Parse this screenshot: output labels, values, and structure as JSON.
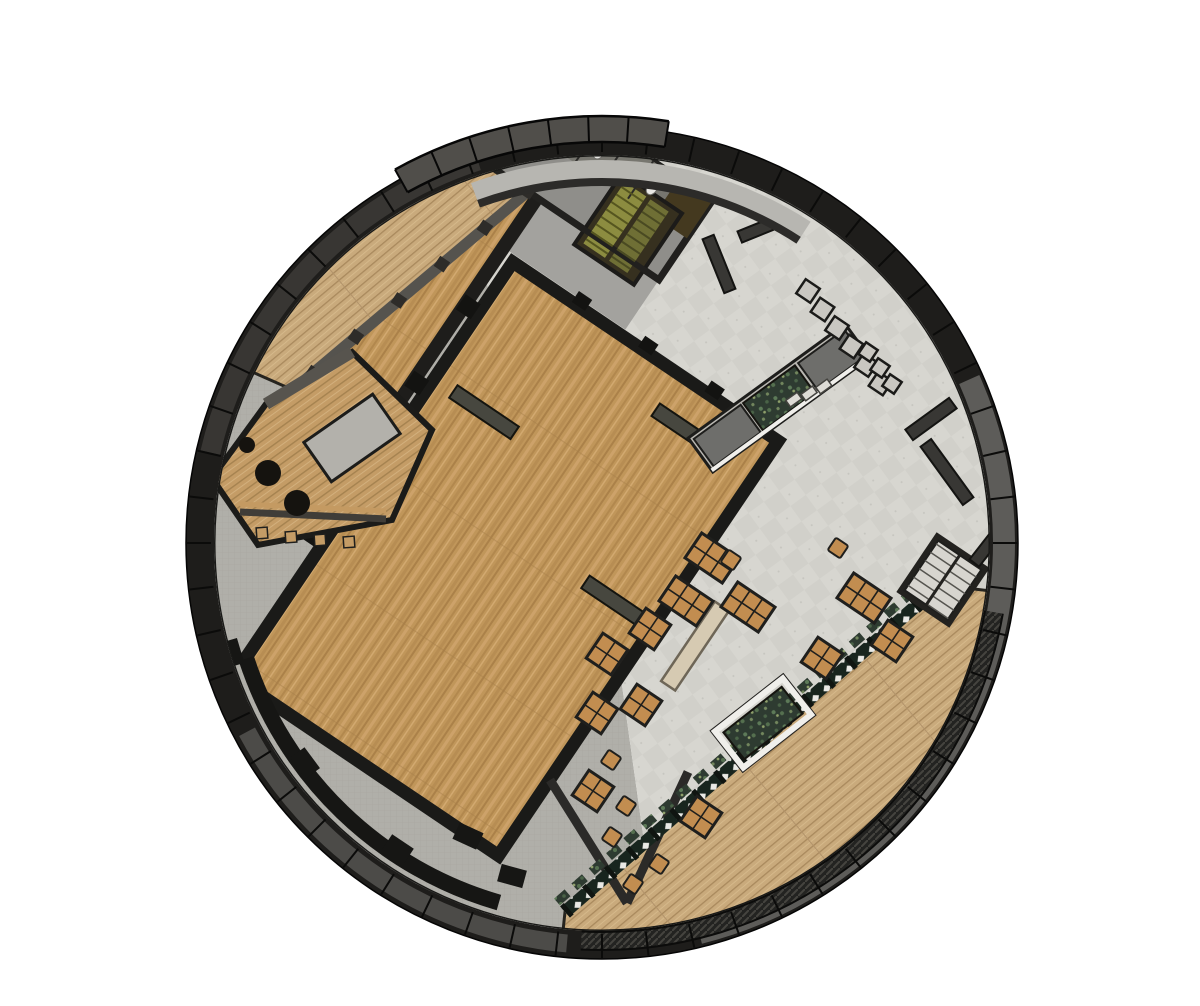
{
  "scene": {
    "type": "architectural-floorplan",
    "description": "Top-down cutaway plan of a circular building with wood halls, tiled lobby, dining terrace and curved outdoor deck",
    "width": 1200,
    "height": 1006,
    "background": "#ffffff"
  },
  "palette": {
    "ring_dark": "#1e1d1b",
    "ring_gray_right": "#5d5c59",
    "ring_gray_bottom": "#4c4b48",
    "ring_brown_topleft": "#383633",
    "canopy": "#504e4a",
    "wall_dark": "#1a1a18",
    "wall_mid": "#55534e",
    "wood_hall": "#c0965a",
    "wood_deck": "#c9aa7c",
    "wood_bar": "#c49c66",
    "tile": "#d7d6d0",
    "tile_alt": "#d1d0ca",
    "concrete": "#b0afa9",
    "corridor_gray": "#a3a29e",
    "services_gray": "#8f8e8a",
    "stall_gray": "#77766f",
    "moss": "#2e3b31",
    "rail_dark": "#18251e",
    "olive_stair": "#8c8c40",
    "olive_stair2": "#6f6f35",
    "stair_brown": "#36301f",
    "table_wood": "#c28d50",
    "bench_gray": "#6e6e6b",
    "planter_base": "#b9b7b1",
    "white_trim": "#f0efeb",
    "stair_tread": "#d7d5cf"
  },
  "geometry": {
    "cx": 602,
    "cy": 543,
    "r_inner": 388,
    "r_ring": 402,
    "r_outer": 416,
    "grid_rotation_deg": 34,
    "tick_count": 56
  },
  "ring": {
    "arcs": [
      {
        "name": "right-gray-panel-arc",
        "a0": -24,
        "a1": 76,
        "r": 402,
        "w": 22,
        "color": "#5d5c59"
      },
      {
        "name": "bottom-gray-panel-arc",
        "a0": 95,
        "a1": 152,
        "r": 402,
        "w": 18,
        "color": "#4c4b48"
      },
      {
        "name": "upperleft-panel-arc",
        "a0": 193,
        "a1": 252,
        "r": 402,
        "w": 20,
        "color": "#383633"
      }
    ],
    "canopy": {
      "a0": 241,
      "a1": 279,
      "r": 414,
      "w": 26
    },
    "deck_rim_hatch": {
      "a0": 10,
      "a1": 93,
      "r": 398,
      "w": 17
    },
    "inner_gap_arc": {
      "a0": 250,
      "a1": 303,
      "r": 373,
      "w": 20,
      "color": "#b7b6b1"
    },
    "inner_wall_arc": {
      "a0": 250,
      "a1": 303,
      "r": 361,
      "w": 8,
      "color": "#2c2b29"
    }
  },
  "floors": {
    "tile_wedge": {
      "a0": 246,
      "a1": 442
    },
    "concrete_wedge": {
      "a0": 82,
      "a1": 246
    },
    "deck_top_left": {
      "pts": [
        [
          293,
          390
        ],
        [
          540,
          200
        ],
        [
          534,
          157
        ]
      ],
      "arc_back": [
        250,
        371
      ],
      "r": 392
    },
    "deck_bottom_right": {
      "start": [
        563,
        931
      ],
      "arc_to": [
        991,
        591
      ],
      "pts": [
        [
          940,
          585
        ],
        [
          565,
          912
        ]
      ],
      "r": 392
    },
    "hall_rim_wall": {
      "a0": 106,
      "a1": 162,
      "r": 374,
      "w": 16
    }
  },
  "rotated_elements": [
    {
      "kind": "rect",
      "name": "corridor-floor",
      "x": -247,
      "y": -250,
      "w": 147,
      "h": 60,
      "fill": "#a3a29e"
    },
    {
      "kind": "path",
      "name": "upper-hall-floor",
      "d": "M -247 -250 L -247 75 L -350 75 L -258 -250 Z",
      "fill": "url(#woodG)",
      "stroke": "#26241f",
      "sw": 3
    },
    {
      "kind": "line",
      "name": "upper-hall-inner-wall",
      "x1": -247,
      "y1": -250,
      "x2": -247,
      "y2": 75,
      "stroke": "#1e1d1b",
      "sw": 14
    },
    {
      "kind": "line",
      "name": "upper-hall-window-wall",
      "x1": -350,
      "y1": 75,
      "x2": -258,
      "y2": -250,
      "stroke": "#55534e",
      "sw": 11
    },
    {
      "kind": "rect",
      "name": "services-block",
      "x": -300,
      "y": -345,
      "w": 200,
      "h": 95,
      "fill": "#8f8e8a",
      "stroke": "#21201e",
      "sw": 7
    },
    {
      "kind": "rect",
      "name": "restroom-stall-strip",
      "x": -300,
      "y": -345,
      "w": 160,
      "h": 45,
      "fill": "#77766f"
    },
    {
      "kind": "rect",
      "name": "storage-dark-block",
      "x": -140,
      "y": -345,
      "w": 40,
      "h": 45,
      "fill": "#44391f"
    },
    {
      "kind": "rect",
      "name": "stairwell-block",
      "x": -190,
      "y": -318,
      "w": 72,
      "h": 86,
      "fill": "#36301f",
      "stroke": "#1c1b19",
      "sw": 4
    },
    {
      "kind": "rect",
      "name": "stair-flight-olive",
      "x": -183,
      "y": -312,
      "w": 26,
      "h": 74,
      "fill": "#8c8c40"
    },
    {
      "kind": "rect",
      "name": "stair-flight-olive2",
      "x": -152,
      "y": -312,
      "w": 22,
      "h": 74,
      "fill": "#6f6f35"
    },
    {
      "kind": "line",
      "name": "services-south-wall",
      "x1": -300,
      "y1": -250,
      "x2": -100,
      "y2": -250,
      "stroke": "#21201e",
      "sw": 6
    },
    {
      "kind": "rect",
      "name": "main-hall-floor",
      "x": -231,
      "y": -183,
      "w": 320,
      "h": 500,
      "fill": "url(#woodG)",
      "stroke": "#1a1a18",
      "sw": 13,
      "clip": "hall"
    },
    {
      "kind": "rect",
      "name": "hall-slat",
      "x": -208,
      "y": -50,
      "w": 74,
      "h": 15,
      "fill": "#47473f",
      "stroke": "#14140f",
      "sw": 2
    },
    {
      "kind": "rect",
      "name": "hall-slat",
      "x": -30,
      "y": -148,
      "w": 64,
      "h": 15,
      "fill": "#47473f",
      "stroke": "#14140f",
      "sw": 2
    },
    {
      "kind": "rect",
      "name": "hall-slat",
      "x": 8,
      "y": 34,
      "w": 70,
      "h": 15,
      "fill": "#47473f",
      "stroke": "#14140f",
      "sw": 2
    },
    {
      "kind": "rect",
      "name": "hall-pillar",
      "x": -252,
      "y": -130,
      "w": 18,
      "h": 18,
      "fill": "#131311"
    },
    {
      "kind": "rect",
      "name": "hall-pillar",
      "x": -252,
      "y": -38,
      "w": 18,
      "h": 18,
      "fill": "#131311"
    },
    {
      "kind": "rect",
      "name": "hall-pillar",
      "x": -252,
      "y": 54,
      "w": 18,
      "h": 18,
      "fill": "#131311"
    },
    {
      "kind": "rect",
      "name": "hall-pillar",
      "x": -252,
      "y": 146,
      "w": 18,
      "h": 18,
      "fill": "#131311"
    },
    {
      "kind": "rect",
      "name": "hall-pillar",
      "x": -160,
      "y": -196,
      "w": 16,
      "h": 13,
      "fill": "#131311"
    },
    {
      "kind": "rect",
      "name": "hall-pillar",
      "x": -80,
      "y": -196,
      "w": 16,
      "h": 13,
      "fill": "#131311"
    },
    {
      "kind": "rect",
      "name": "hall-pillar",
      "x": 0,
      "y": -196,
      "w": 16,
      "h": 13,
      "fill": "#131311"
    }
  ],
  "toilets": {
    "count": 5,
    "x0": -285,
    "dx": 32,
    "cy": -322,
    "rx": 5,
    "ry": 7
  },
  "window_posts": {
    "count": 6,
    "from": [
      -350,
      75
    ],
    "to": [
      -258,
      -250
    ],
    "size": 12
  },
  "balustrade": {
    "x1": 565,
    "y1": 912,
    "x2": 940,
    "y2": 585,
    "fringe": [
      557,
      902,
      932,
      575
    ]
  },
  "terrace_walls": [
    {
      "x1": 550,
      "y1": 780,
      "x2": 627,
      "y2": 903
    },
    {
      "x1": 688,
      "y1": 772,
      "x2": 627,
      "y2": 903
    }
  ],
  "planter_bench": {
    "cx": 779,
    "cy": 398,
    "rot": -36,
    "len": 194,
    "w": 42
  },
  "long_bench": {
    "cx": 695,
    "cy": 646,
    "rot": -56,
    "len": 96,
    "w": 17
  },
  "white_planter": {
    "cx": 763,
    "cy": 723,
    "rot": -38,
    "w": 92,
    "h": 52
  },
  "right_stair": {
    "cx": 943,
    "cy": 580,
    "rot": 34,
    "w": 64,
    "h": 72
  },
  "zigzag_desks": [
    {
      "x0": 808,
      "y0": 291,
      "dx": 14.5,
      "dy": 18.5,
      "n": 6,
      "s": 17
    },
    {
      "x0": 868,
      "y0": 352,
      "dx": 12,
      "dy": 16,
      "n": 3,
      "s": 14
    }
  ],
  "wall_jogs": [
    {
      "cx": 931,
      "cy": 419,
      "w": 54,
      "h": 13,
      "rot": -36
    },
    {
      "cx": 947,
      "cy": 472,
      "w": 13,
      "h": 72,
      "rot": -36
    },
    {
      "cx": 762,
      "cy": 228,
      "w": 48,
      "h": 12,
      "rot": -22
    },
    {
      "cx": 719,
      "cy": 264,
      "w": 12,
      "h": 58,
      "rot": -22
    },
    {
      "cx": 986,
      "cy": 548,
      "w": 38,
      "h": 12,
      "rot": -52
    }
  ],
  "rim_blocks": [
    {
      "cx": 232,
      "cy": 653
    },
    {
      "cx": 305,
      "cy": 763
    },
    {
      "cx": 398,
      "cy": 849
    },
    {
      "cx": 468,
      "cy": 836
    },
    {
      "cx": 512,
      "cy": 876
    }
  ],
  "bar_area": {
    "outline": "M 212 478 L 266 404 L 352 352 L 432 430 L 392 520 L 258 545 Z",
    "island": {
      "cx": 352,
      "cy": 438,
      "rot": -35,
      "w": 84,
      "h": 48
    },
    "shelf_wall": {
      "x1": 266,
      "y1": 404,
      "x2": 352,
      "y2": 352
    },
    "counter": {
      "x1": 240,
      "y1": 512,
      "x2": 386,
      "y2": 519
    },
    "round_tables": [
      {
        "cx": 268,
        "cy": 473,
        "r": 13
      },
      {
        "cx": 297,
        "cy": 503,
        "r": 13
      },
      {
        "cx": 247,
        "cy": 445,
        "r": 8
      }
    ],
    "stools": [
      {
        "cx": 262,
        "cy": 533
      },
      {
        "cx": 291,
        "cy": 537
      },
      {
        "cx": 320,
        "cy": 540
      },
      {
        "cx": 349,
        "cy": 542
      }
    ]
  },
  "furniture": {
    "cell_size": 15,
    "dining_tables": [
      {
        "x": 712,
        "y": 558,
        "cols": 3,
        "rows": 2
      },
      {
        "x": 686,
        "y": 601,
        "cols": 3,
        "rows": 2
      },
      {
        "x": 748,
        "y": 607,
        "cols": 3,
        "rows": 2
      },
      {
        "x": 864,
        "y": 598,
        "cols": 3,
        "rows": 2
      },
      {
        "x": 650,
        "y": 629,
        "cols": 2,
        "rows": 2
      },
      {
        "x": 607,
        "y": 654,
        "cols": 2,
        "rows": 2
      },
      {
        "x": 597,
        "y": 713,
        "cols": 2,
        "rows": 2
      },
      {
        "x": 641,
        "y": 705,
        "cols": 2,
        "rows": 2
      },
      {
        "x": 593,
        "y": 791,
        "cols": 2,
        "rows": 2
      },
      {
        "x": 701,
        "y": 817,
        "cols": 2,
        "rows": 2
      },
      {
        "x": 822,
        "y": 658,
        "cols": 2,
        "rows": 2
      },
      {
        "x": 892,
        "y": 641,
        "cols": 2,
        "rows": 2
      }
    ],
    "chairs": [
      {
        "x": 626,
        "y": 806
      },
      {
        "x": 611,
        "y": 760
      },
      {
        "x": 731,
        "y": 560
      },
      {
        "x": 838,
        "y": 548
      },
      {
        "x": 633,
        "y": 884
      },
      {
        "x": 612,
        "y": 837
      },
      {
        "x": 659,
        "y": 864
      }
    ]
  }
}
